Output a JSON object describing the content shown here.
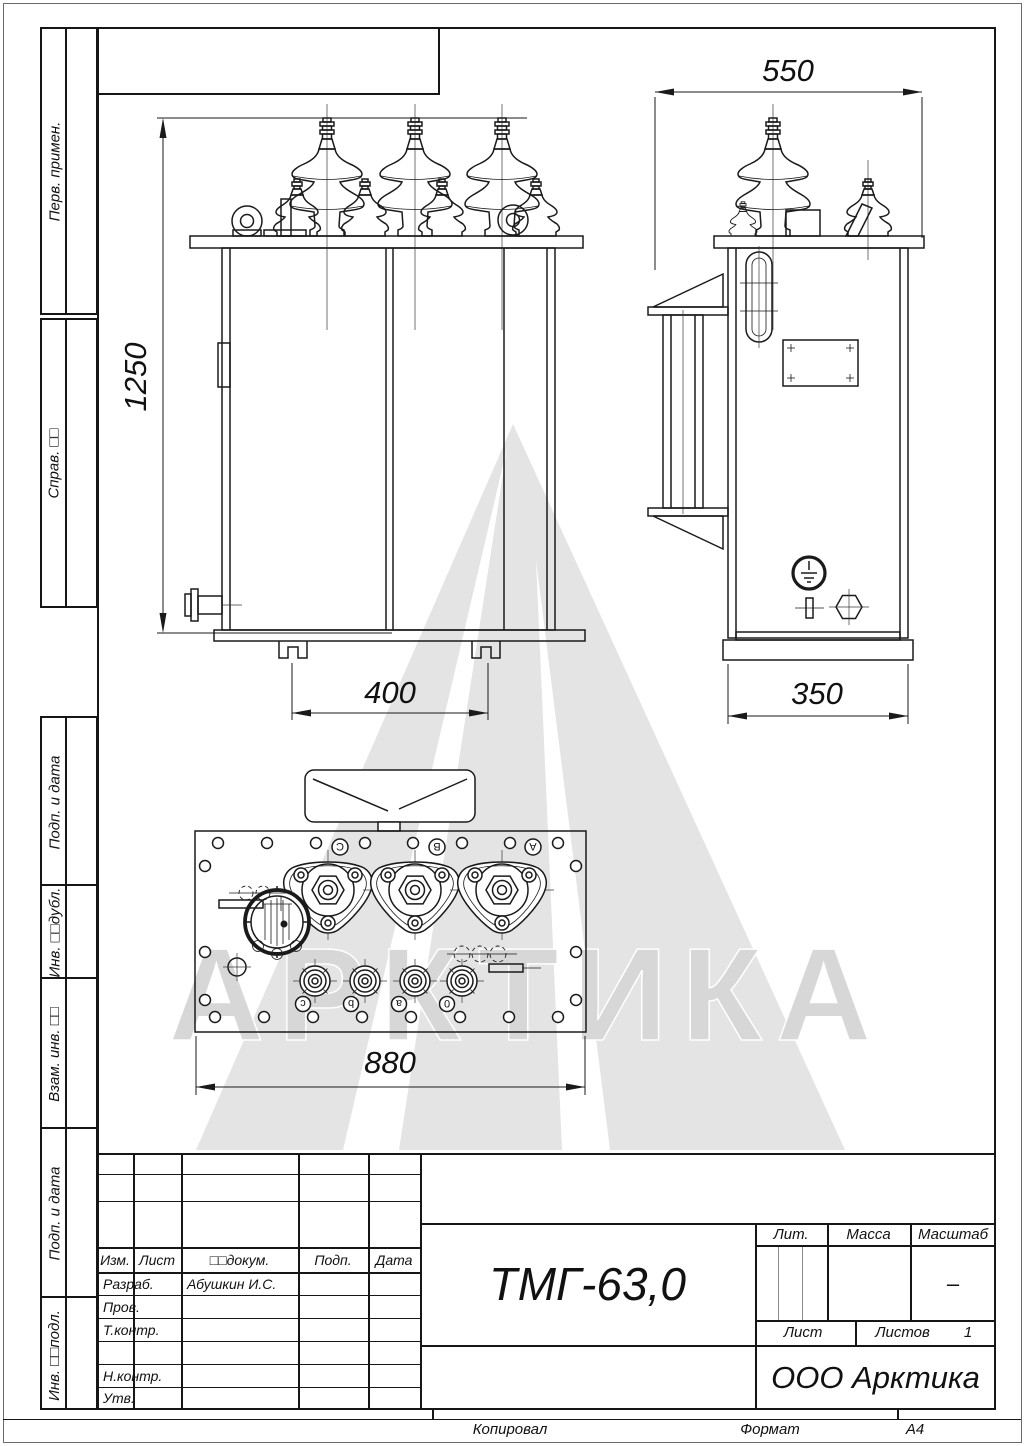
{
  "watermark": {
    "text": "АРКТИКА"
  },
  "sidebar": {
    "items": [
      {
        "label": "Перв. примен."
      },
      {
        "label": "Справ. □□"
      },
      {
        "label": "Подп. и дата"
      },
      {
        "label": "Инв. □□дубл."
      },
      {
        "label": "Взам. инв. □□"
      },
      {
        "label": "Подп. и дата"
      },
      {
        "label": "Инв. □□подл."
      }
    ]
  },
  "drawing": {
    "dim_height": "1250",
    "dim_top_width": "550",
    "dim_feet": "400",
    "dim_depth": "350",
    "dim_length": "880",
    "hv_a": "A",
    "hv_b": "B",
    "hv_c": "C",
    "lv_a": "a",
    "lv_b": "b",
    "lv_c": "c",
    "lv_zero": "0"
  },
  "title_block": {
    "designation": "ТМГ-63,0",
    "company": "ООО Арктика",
    "col_izm": "Изм.",
    "col_list": "Лист",
    "col_doc": "□□докум.",
    "col_podp": "Подп.",
    "col_data": "Дата",
    "row_razrab": "Разраб.",
    "razrab_name": "Абушкин И.С.",
    "row_prov": "Пров.",
    "row_tkontr": "Т.контр.",
    "row_nkontr": "Н.контр.",
    "row_utv": "Утв.",
    "lit": "Лит.",
    "massa": "Масса",
    "masshtab": "Масштаб",
    "masshtab_value": "–",
    "list": "Лист",
    "listov": "Листов",
    "listov_value": "1"
  },
  "footer": {
    "kopiroval": "Копировал",
    "format_label": "Формат",
    "format_value": "А4"
  }
}
